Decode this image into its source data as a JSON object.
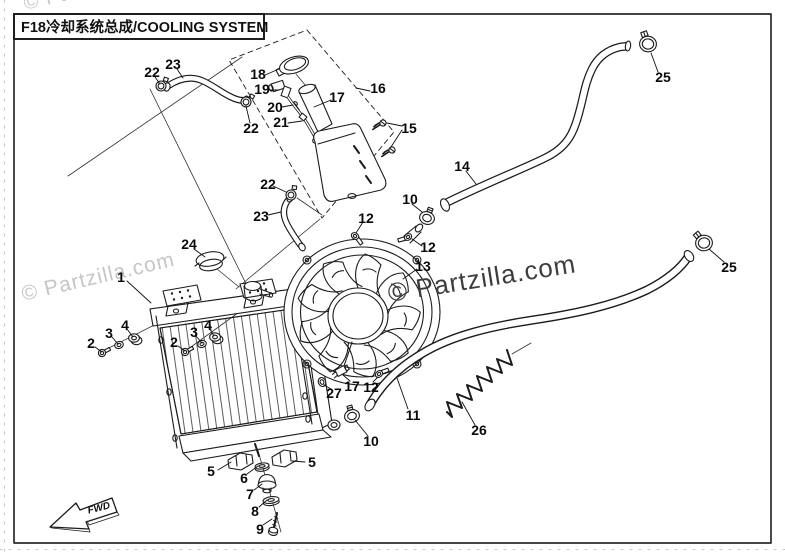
{
  "title": "F18冷却系统总成/COOLING SYSTEM",
  "watermarks": {
    "top_left": "© Partzilla.com",
    "left": "© Partzilla.com",
    "center": "© Partzilla.com"
  },
  "direction_label": "FWD",
  "colors": {
    "background": "#ffffff",
    "line_art": "#1c1c1c",
    "frame": "#2a2a2a",
    "watermark_light": "#c7c7c7",
    "watermark_dark": "#3d3d3d"
  },
  "callouts": [
    {
      "label": "1"
    },
    {
      "label": "2"
    },
    {
      "label": "3"
    },
    {
      "label": "4"
    },
    {
      "label": "2"
    },
    {
      "label": "3"
    },
    {
      "label": "4"
    },
    {
      "label": "5"
    },
    {
      "label": "5"
    },
    {
      "label": "6"
    },
    {
      "label": "7"
    },
    {
      "label": "8"
    },
    {
      "label": "9"
    },
    {
      "label": "10"
    },
    {
      "label": "10"
    },
    {
      "label": "11"
    },
    {
      "label": "12"
    },
    {
      "label": "12"
    },
    {
      "label": "12"
    },
    {
      "label": "13"
    },
    {
      "label": "14"
    },
    {
      "label": "15"
    },
    {
      "label": "16"
    },
    {
      "label": "17"
    },
    {
      "label": "17"
    },
    {
      "label": "18"
    },
    {
      "label": "19"
    },
    {
      "label": "20"
    },
    {
      "label": "21"
    },
    {
      "label": "22"
    },
    {
      "label": "22"
    },
    {
      "label": "22"
    },
    {
      "label": "23"
    },
    {
      "label": "23"
    },
    {
      "label": "24"
    },
    {
      "label": "25"
    },
    {
      "label": "25"
    },
    {
      "label": "26"
    },
    {
      "label": "27"
    }
  ]
}
